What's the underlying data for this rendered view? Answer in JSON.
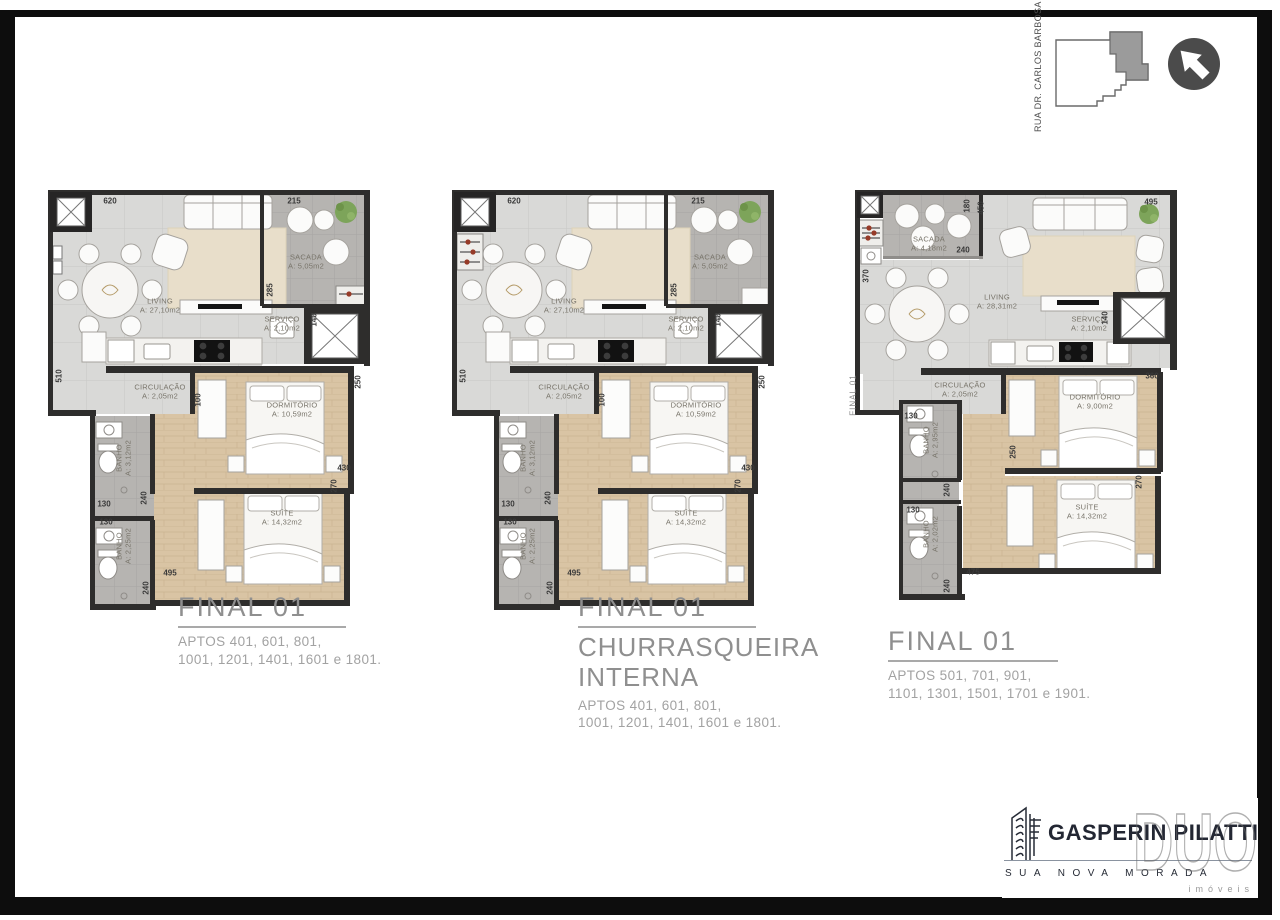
{
  "site_key": {
    "street_label": "RUA DR. CARLOS BARBOSA",
    "north_arrow_icon": "arrow-northwest",
    "unit_highlight_icon": "building-footprint"
  },
  "plans": [
    {
      "title": "FINAL 01",
      "aptos": [
        "APTOS 401, 601, 801,",
        "1001, 1201, 1401, 1601 e 1801."
      ],
      "rooms": {
        "living": {
          "name": "LIVING",
          "area": "A: 27,10m2"
        },
        "sacada": {
          "name": "SACADA",
          "area": "A: 5,05m2"
        },
        "servico": {
          "name": "SERVIÇO",
          "area": "A: 2,10m2"
        },
        "circulacao": {
          "name": "CIRCULAÇÃO",
          "area": "A: 2,05m2"
        },
        "dormitorio": {
          "name": "DORMITÓRIO",
          "area": "A: 10,59m2"
        },
        "suite": {
          "name": "SUÍTE",
          "area": "A: 14,32m2"
        },
        "banho1": {
          "name": "BANHO",
          "area": "A: 3,12m2"
        },
        "banho2": {
          "name": "BANHO",
          "area": "A: 2,25m2"
        }
      },
      "dimensions": [
        "620",
        "215",
        "285",
        "140",
        "250",
        "430",
        "270",
        "510",
        "100",
        "130",
        "240",
        "130",
        "240",
        "495"
      ]
    },
    {
      "title": "FINAL 01",
      "subtitle": [
        "CHURRASQUEIRA",
        "INTERNA"
      ],
      "aptos": [
        "APTOS 401, 601, 801,",
        "1001, 1201, 1401, 1601 e 1801."
      ],
      "rooms": {
        "living": {
          "name": "LIVING",
          "area": "A: 27,10m2"
        },
        "sacada": {
          "name": "SACADA",
          "area": "A: 5,05m2"
        },
        "servico": {
          "name": "SERVIÇO",
          "area": "A: 2,10m2"
        },
        "circulacao": {
          "name": "CIRCULAÇÃO",
          "area": "A: 2,05m2"
        },
        "dormitorio": {
          "name": "DORMITÓRIO",
          "area": "A: 10,59m2"
        },
        "suite": {
          "name": "SUÍTE",
          "area": "A: 14,32m2"
        },
        "banho1": {
          "name": "BANHO",
          "area": "A: 3,12m2"
        },
        "banho2": {
          "name": "BANHO",
          "area": "A: 2,25m2"
        }
      },
      "dimensions": [
        "620",
        "215",
        "285",
        "140",
        "250",
        "430",
        "270",
        "510",
        "100",
        "130",
        "240",
        "130",
        "240",
        "495"
      ]
    },
    {
      "title": "FINAL 01",
      "side_label": "FINAL 01",
      "aptos": [
        "APTOS 501, 701, 901,",
        "1101, 1301, 1501, 1701 e 1901."
      ],
      "rooms": {
        "living": {
          "name": "LIVING",
          "area": "A: 28,31m2"
        },
        "sacada": {
          "name": "SACADA",
          "area": "A: 4,18m2"
        },
        "servico": {
          "name": "SERVIÇO",
          "area": "A: 2,10m2"
        },
        "circulacao": {
          "name": "CIRCULAÇÃO",
          "area": "A: 2,05m2"
        },
        "dormitorio": {
          "name": "DORMITÓRIO",
          "area": "A: 9,00m2"
        },
        "suite": {
          "name": "SUÍTE",
          "area": "A: 14,32m2"
        },
        "banho1": {
          "name": "BANHO",
          "area": "A: 2,95m2"
        },
        "banho2": {
          "name": "BANHO",
          "area": "A: 2,02m2"
        }
      },
      "dimensions": [
        "180",
        "450",
        "495",
        "240",
        "370",
        "140",
        "360",
        "130",
        "250",
        "240",
        "130",
        "475",
        "240",
        "270"
      ]
    }
  ],
  "footer": {
    "brand": "GASPERIN PILATTI",
    "tagline": "SUA NOVA MORADA",
    "partner_logo": "DUO",
    "partner_caption": "imóveis"
  }
}
